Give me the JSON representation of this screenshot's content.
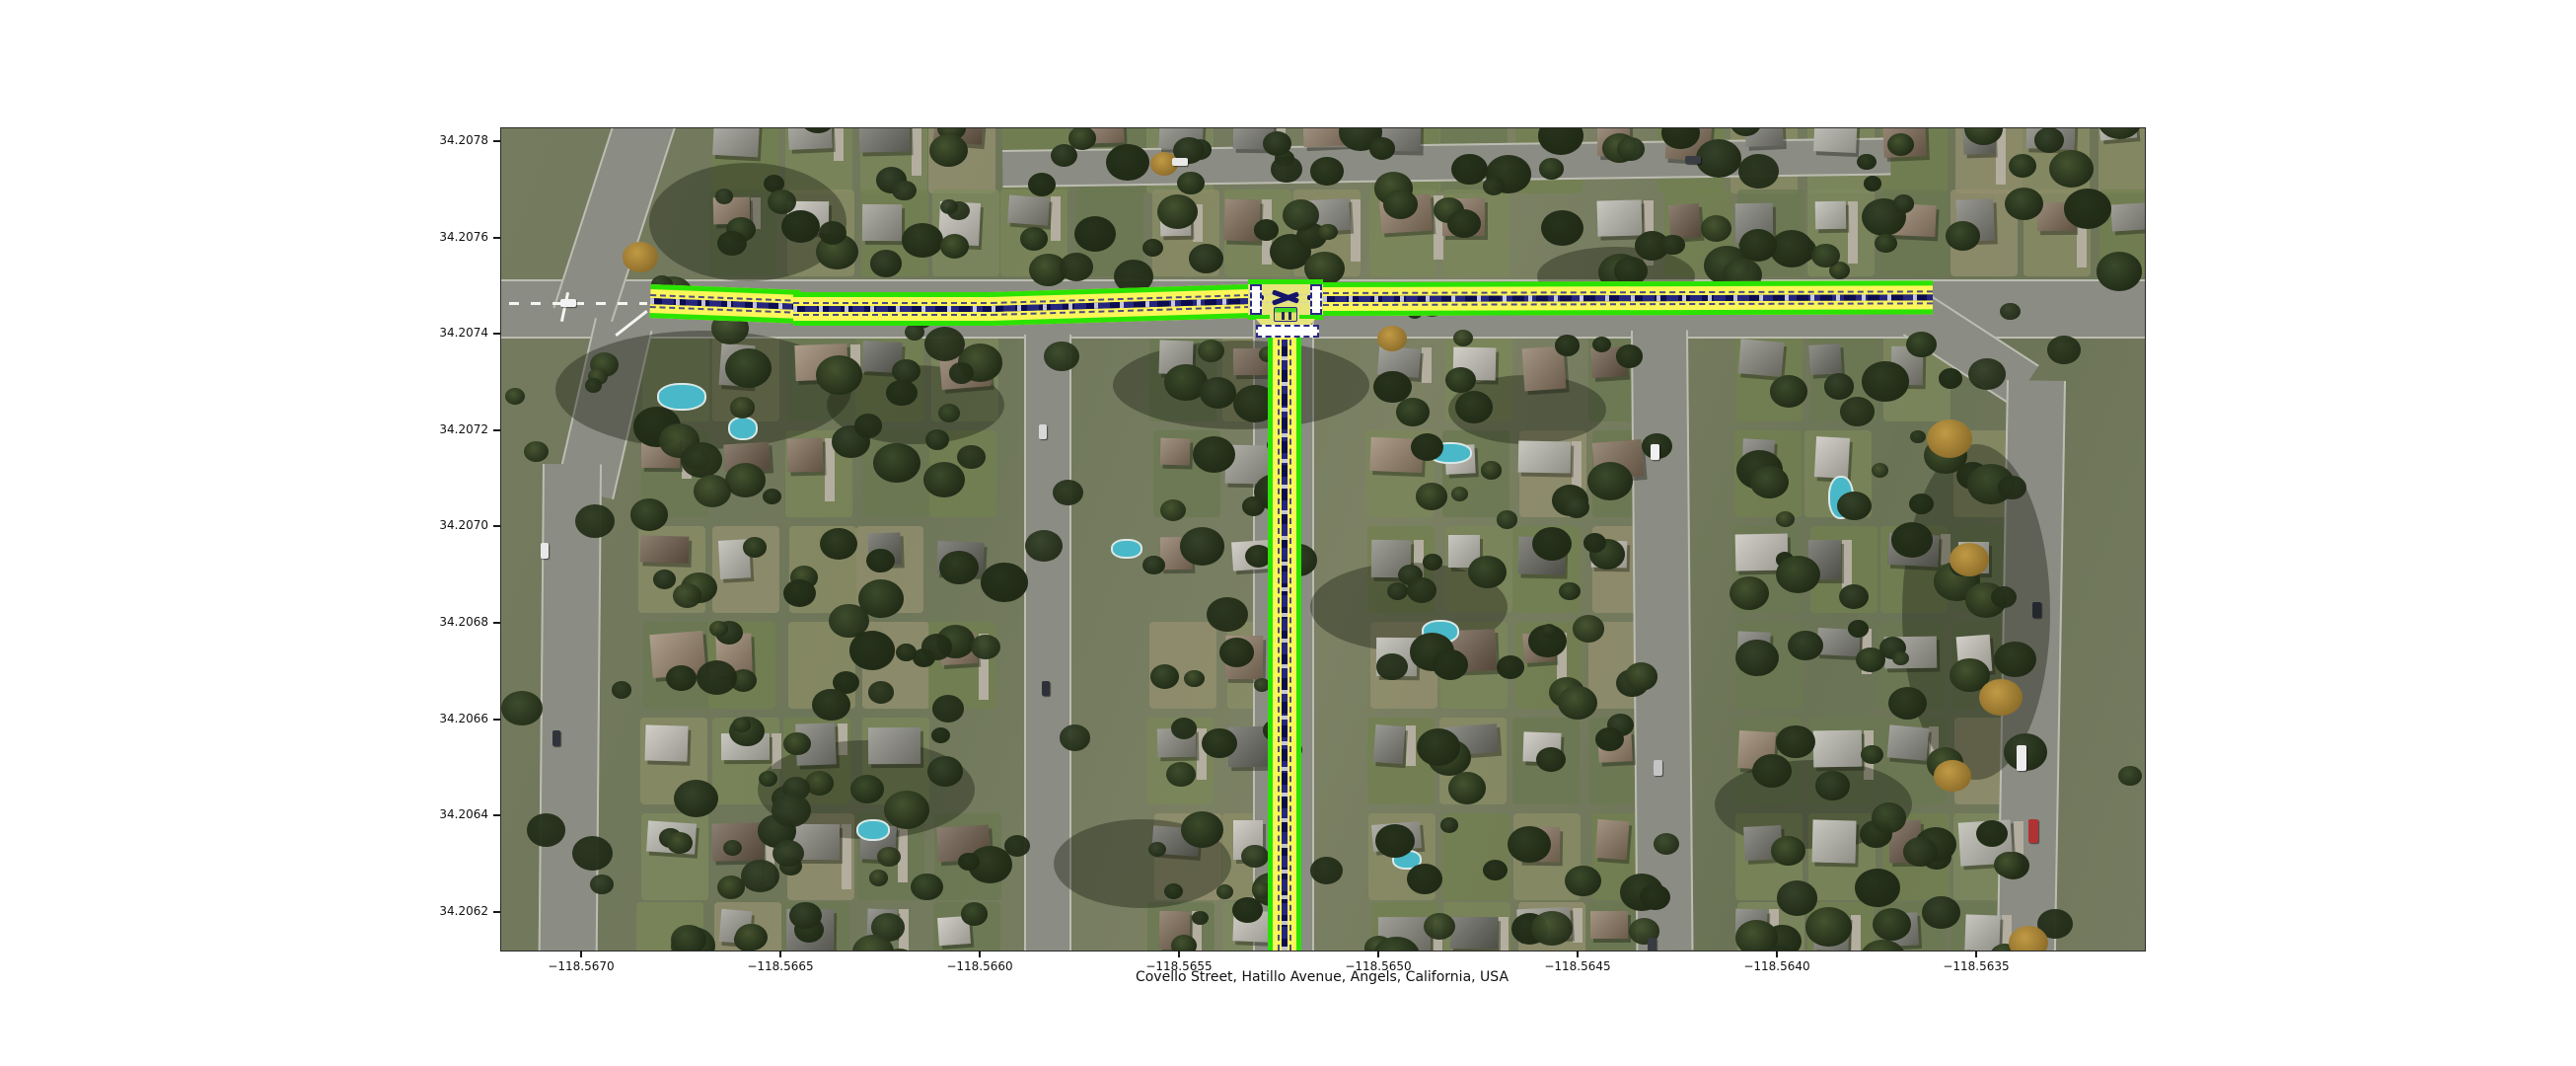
{
  "figure": {
    "xlabel": "Covello Street, Hatillo Avenue, Angels, California, USA",
    "x_axis": {
      "ticks": [
        "−118.5670",
        "−118.5665",
        "−118.5660",
        "−118.5655",
        "−118.5650",
        "−118.5645",
        "−118.5640",
        "−118.5635"
      ]
    },
    "y_axis": {
      "ticks": [
        "34.2078",
        "34.2076",
        "34.2074",
        "34.2072",
        "34.2070",
        "34.2068",
        "34.2066",
        "34.2064",
        "34.2062"
      ]
    }
  },
  "map": {
    "type": "aerial-imagery-with-road-overlay",
    "highlighted_roads": [
      {
        "name": "Covello Street",
        "orientation": "horizontal"
      },
      {
        "name": "Hatillo Avenue",
        "orientation": "vertical"
      }
    ],
    "overlay_colors": {
      "edge": "#2be300",
      "lane": "#fcf65a",
      "centerline": "#151569",
      "junction_fill": "#e8e47c",
      "stop_bar": "#ffffff"
    },
    "junction": {
      "stop_bars": 3,
      "marker_icon": "lane-direction-marker"
    }
  }
}
